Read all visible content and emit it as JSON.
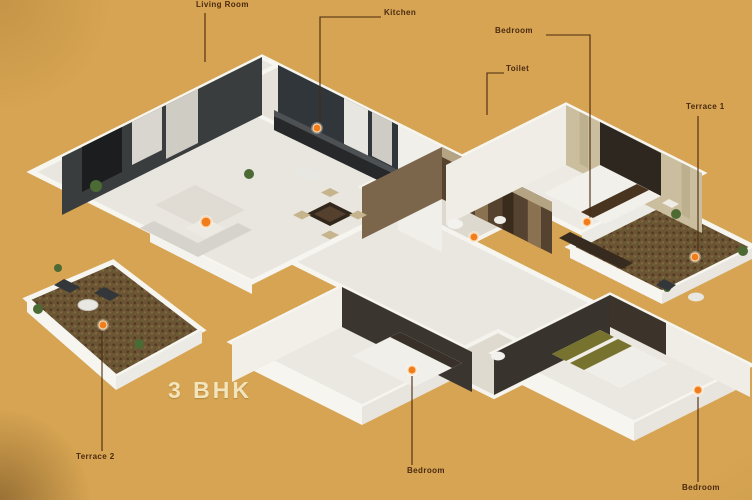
{
  "plan_title": "3 BHK",
  "labels": {
    "living_room": "Living Room",
    "kitchen": "Kitchen",
    "bedroom_master": "Bedroom",
    "toilet": "Toilet",
    "terrace_right": "Terrace 1",
    "terrace_left": "Terrace 2",
    "bedroom_middle": "Bedroom",
    "bedroom_right": "Bedroom"
  },
  "colors": {
    "background": "#d6a452",
    "hotspot": "#f07c1c",
    "label_text": "#4a2a10",
    "title_text": "#f2e4bd",
    "dark_wall": "#3a3d3e",
    "tile_wall": "#55422f"
  },
  "hotspots": {
    "icon": "orange-dot",
    "locations": [
      "living-room",
      "kitchen",
      "toilet",
      "bedroom-master",
      "terrace-1",
      "terrace-2",
      "bedroom-middle",
      "bedroom-right"
    ]
  }
}
